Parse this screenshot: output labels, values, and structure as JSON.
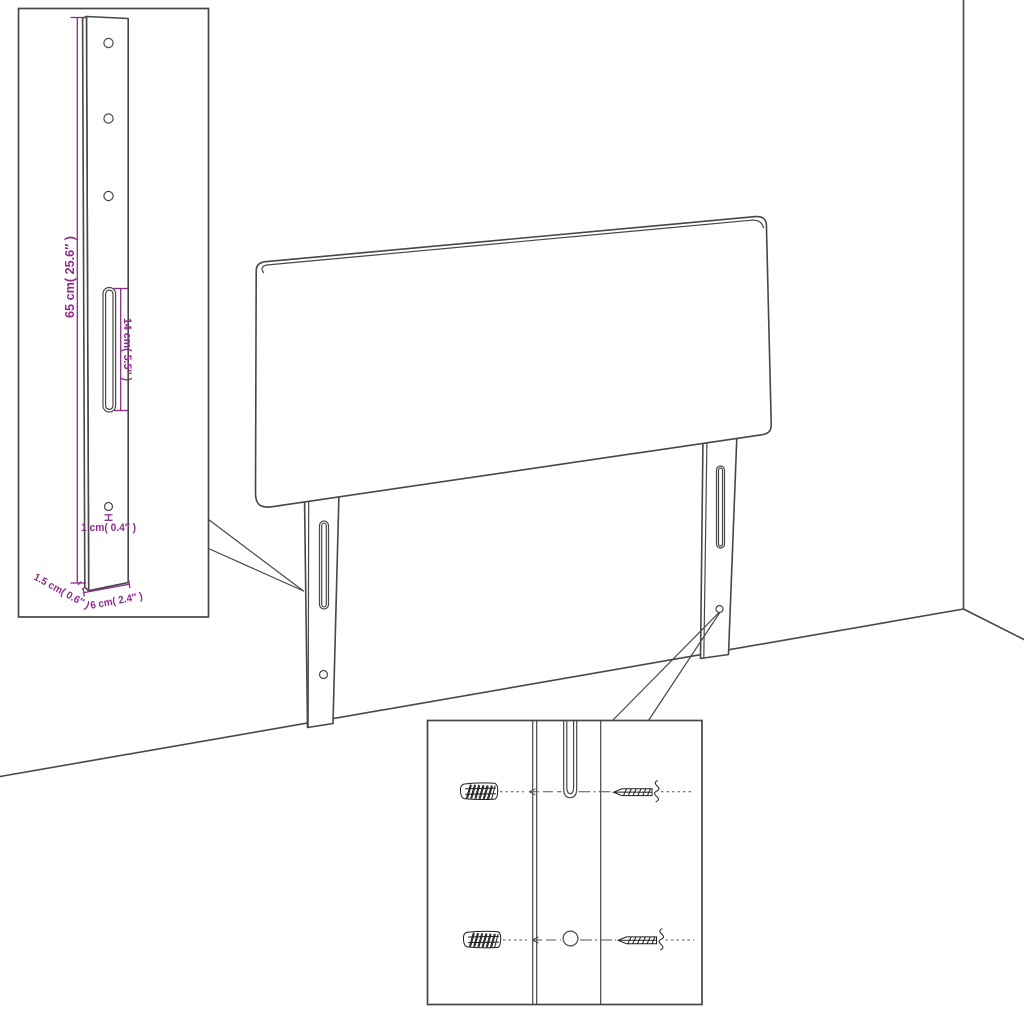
{
  "title": "Headboard wall-mounting instruction diagram",
  "colors": {
    "background": "#ffffff",
    "line": "#474747",
    "dimension_annotation": "#8e2b8a",
    "hardware_ink": "#1f1f1f"
  },
  "labels": {
    "leg_height": "65 cm( 25.6″ )",
    "slot_length": "14 cm( 5.5″ )",
    "hole_diameter": "1 cm( 0.4″ )",
    "leg_depth": "1.5 cm( 0.6″ )",
    "leg_width": "6 cm( 2.4″ )"
  },
  "components": {
    "main_scene": [
      "headboard-panel",
      "left-mounting-leg",
      "right-mounting-leg",
      "room-corner"
    ],
    "leg_dimension_inset": [
      "mounting-leg-detail",
      "screw-holes",
      "keyhole-slot"
    ],
    "hardware_inset": [
      "wall-anchors",
      "screws",
      "leg-slot-closeup",
      "leg-hole-closeup"
    ],
    "wall_anchor_count": 2,
    "screw_count": 2
  }
}
